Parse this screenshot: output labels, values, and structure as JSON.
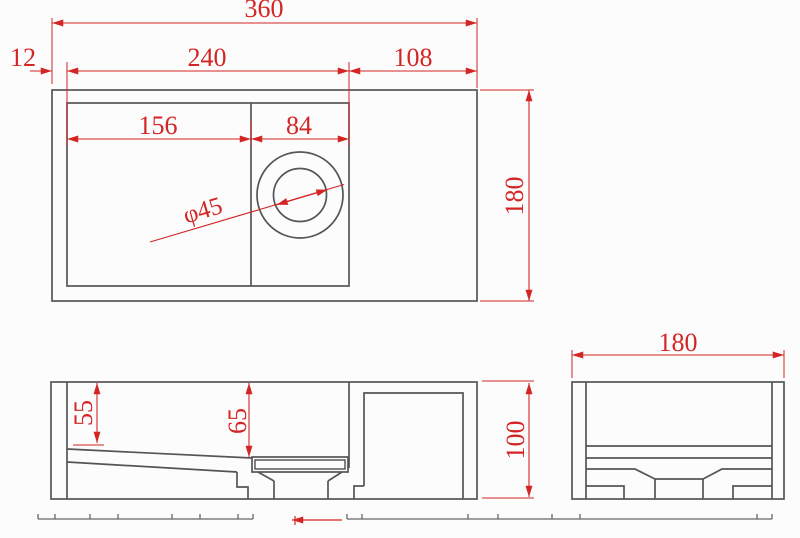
{
  "drawing": {
    "colors": {
      "background": "#fcfcfc",
      "geometry_line": "#555555",
      "dimension": "#d42525"
    },
    "top_view": {
      "overall_width": "360",
      "left_offset": "12",
      "basin_opening_width": "240",
      "right_section_width": "108",
      "left_basin_width": "156",
      "drain_section_width": "84",
      "drain_hole_diameter": "φ45",
      "overall_depth": "180"
    },
    "front_view": {
      "left_inner_depth": "55",
      "drain_side_depth": "65",
      "overall_height": "100"
    },
    "side_view": {
      "overall_depth": "180"
    }
  }
}
